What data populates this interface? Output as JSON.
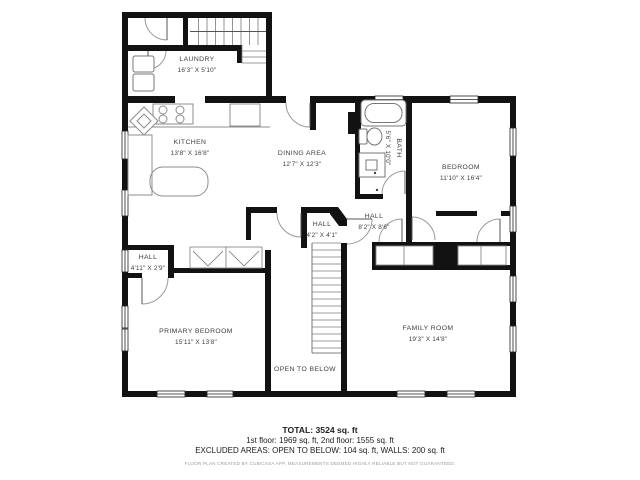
{
  "title": "Second floor plan",
  "colors": {
    "wall": "#121212",
    "fixture_line": "#8c8c8c",
    "door_arc": "#999999",
    "label_text": "#3d3d3d"
  },
  "rooms": [
    {
      "name": "LAUNDRY",
      "dims": "16'3\" X 5'10\""
    },
    {
      "name": "KITCHEN",
      "dims": "13'8\" X 16'8\""
    },
    {
      "name": "DINING AREA",
      "dims": "12'7\" X 12'3\""
    },
    {
      "name": "BATH",
      "dims": "5'6\" X 10'0\""
    },
    {
      "name": "BEDROOM",
      "dims": "11'10\" X 16'4\""
    },
    {
      "name": "HALL",
      "dims": "8'2\" X 8'6\""
    },
    {
      "name": "HALL",
      "dims": "4'2\" X 4'1\""
    },
    {
      "name": "HALL",
      "dims": "4'11\" X 2'9\""
    },
    {
      "name": "PRIMARY BEDROOM",
      "dims": "15'11\" X 13'8\""
    },
    {
      "name": "FAMILY ROOM",
      "dims": "19'3\" X 14'8\""
    },
    {
      "name": "OPEN TO BELOW",
      "dims": ""
    }
  ],
  "summary": {
    "total": "TOTAL: 3524 sq. ft",
    "floors": "1st floor: 1969 sq. ft, 2nd floor: 1555 sq. ft",
    "excluded": "EXCLUDED AREAS: OPEN TO BELOW: 104 sq. ft, WALLS: 200 sq. ft",
    "disclaimer": "FLOOR PLAN CREATED BY CUBICASA APP. MEASUREMENTS DEEMED HIGHLY RELIABLE BUT NOT GUARANTEED."
  }
}
